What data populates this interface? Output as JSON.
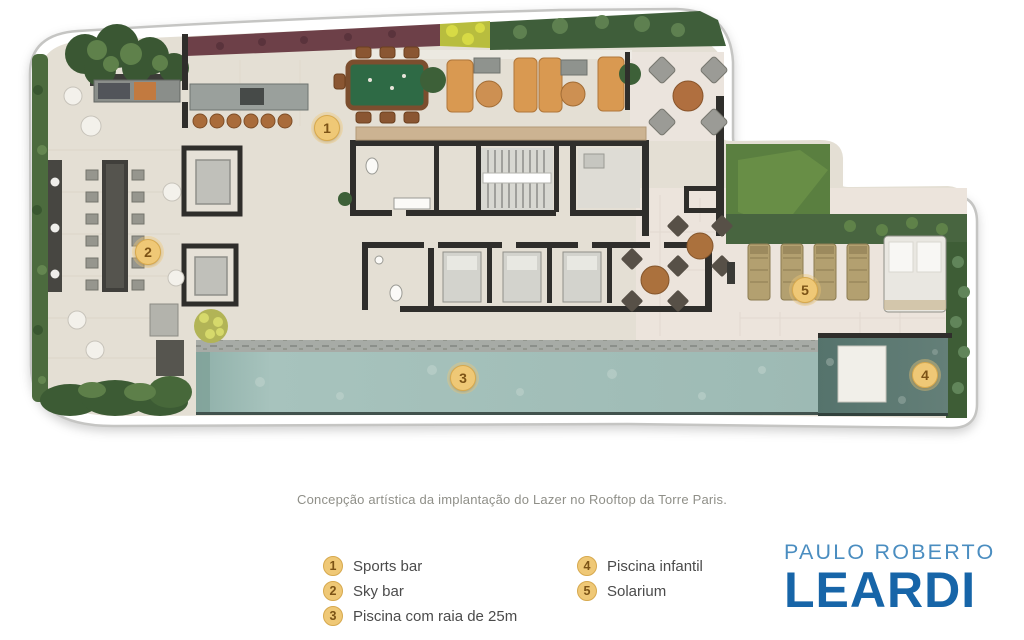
{
  "plan": {
    "markers": [
      {
        "number": "1"
      },
      {
        "number": "2"
      },
      {
        "number": "3"
      },
      {
        "number": "4"
      },
      {
        "number": "5"
      }
    ]
  },
  "caption": "Concepção artística da implantação do Lazer no Rooftop da Torre Paris.",
  "legend": {
    "items": [
      {
        "number": "1",
        "label": "Sports bar"
      },
      {
        "number": "2",
        "label": "Sky bar"
      },
      {
        "number": "3",
        "label": "Piscina com raia de 25m"
      },
      {
        "number": "4",
        "label": "Piscina infantil"
      },
      {
        "number": "5",
        "label": "Solarium"
      }
    ]
  },
  "logo": {
    "line1": "PAULO ROBERTO",
    "line2": "LEARDI"
  },
  "colors": {
    "marker_bg": "#efc876",
    "marker_border": "#d7a94e",
    "marker_text": "#7c5316",
    "caption_text": "#8f8f88",
    "legend_text": "#4b4b4b",
    "logo_light_blue": "#4a8dc0",
    "logo_dark_blue": "#1765a8",
    "pool": "#a7c3bd",
    "kids_pool": "#5e7b74"
  }
}
